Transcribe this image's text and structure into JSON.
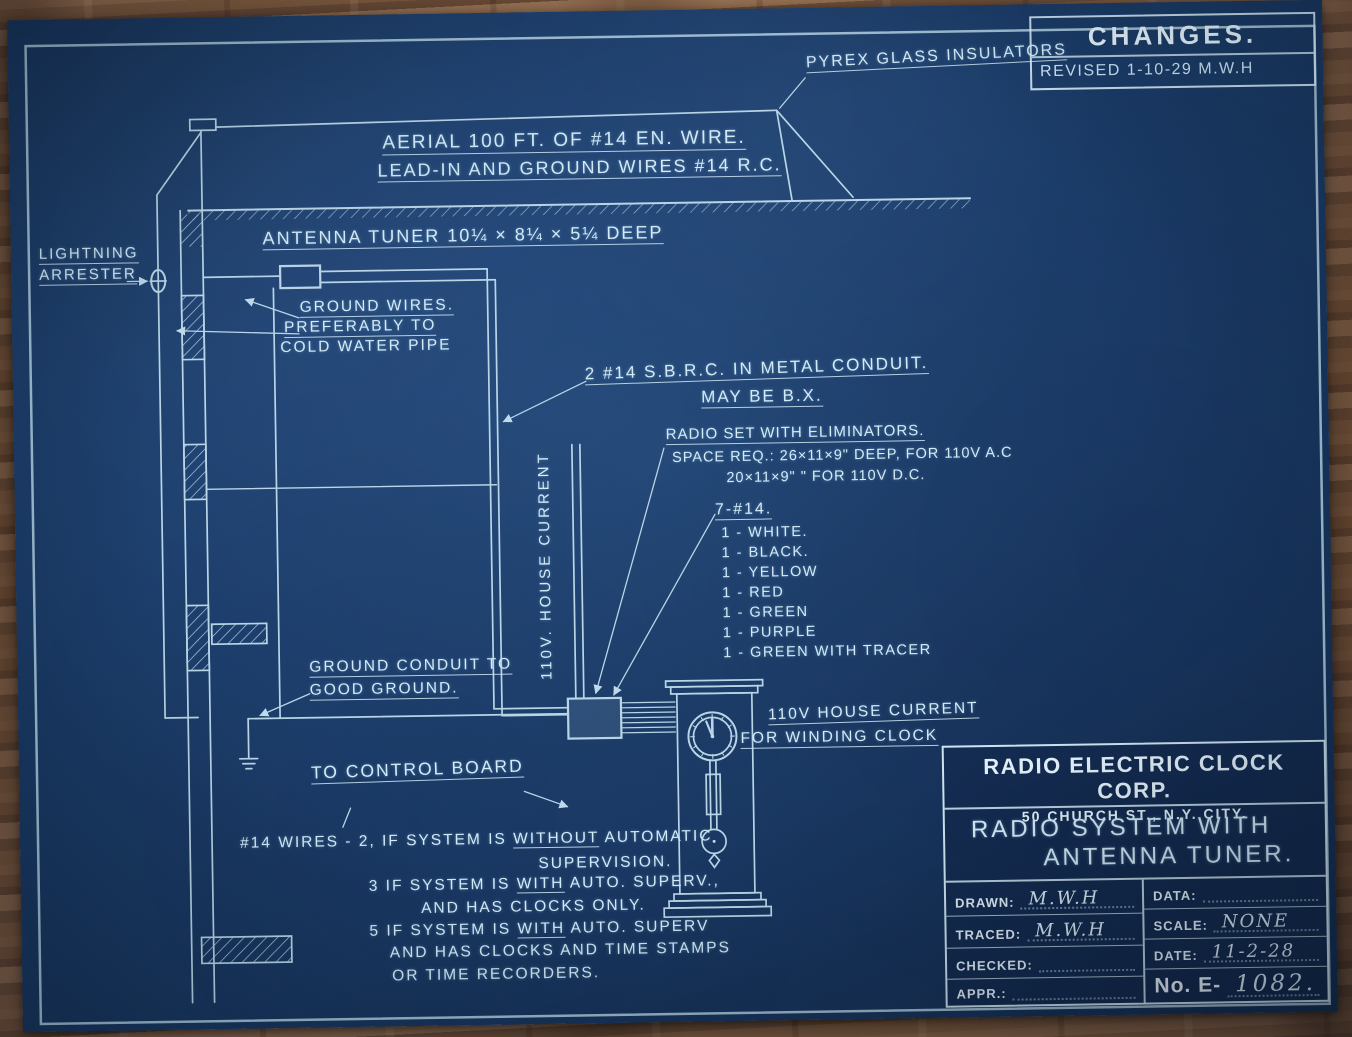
{
  "changes": {
    "title": "CHANGES.",
    "revised": "REVISED 1-10-29 M.W.H"
  },
  "labels": {
    "pyrex": "PYREX GLASS INSULATORS",
    "aerial1": "AERIAL 100 FT. OF #14 EN. WIRE.",
    "aerial2": "LEAD-IN AND GROUND WIRES #14 R.C.",
    "tuner": "ANTENNA TUNER 10¼ × 8¼ × 5¼ DEEP",
    "lightning1": "LIGHTNING",
    "lightning2": "ARRESTER",
    "ground1": "GROUND WIRES.",
    "ground2": "PREFERABLY TO",
    "ground3": "COLD WATER PIPE",
    "conduit1": "2 #14 S.B.R.C. IN METAL CONDUIT.",
    "conduit2": "MAY BE B.X.",
    "radio1": "RADIO SET WITH ELIMINATORS.",
    "radio2": "SPACE REQ.: 26×11×9\" DEEP, FOR 110V A.C",
    "radio3": "20×11×9\"   \"        FOR 110V D.C.",
    "seven_title": "7-#14.",
    "house_current": "110V. HOUSE CURRENT",
    "ground_conduit1": "GROUND CONDUIT TO",
    "ground_conduit2": "GOOD GROUND.",
    "winding1": "110V HOUSE CURRENT",
    "winding2": "FOR WINDING CLOCK",
    "control_board": "TO CONTROL BOARD"
  },
  "wire_list": [
    "1 - WHITE.",
    "1 - BLACK.",
    "1 - YELLOW",
    "1 - RED",
    "1 - GREEN",
    "1 - PURPLE",
    "1 - GREEN WITH TRACER"
  ],
  "notes": {
    "l1a": "#14 WIRES - 2, IF SYSTEM IS ",
    "l1b": "WITHOUT",
    "l1c": " AUTOMATIC",
    "l2": "SUPERVISION.",
    "l3a": "3 IF SYSTEM IS ",
    "l3b": "WITH",
    "l3c": " AUTO. SUPERV.,",
    "l4": "AND HAS CLOCKS ONLY.",
    "l5a": "5 IF SYSTEM IS ",
    "l5b": "WITH",
    "l5c": " AUTO. SUPERV",
    "l6": "AND HAS CLOCKS AND TIME STAMPS",
    "l7": "OR TIME RECORDERS."
  },
  "title_block": {
    "company": "RADIO ELECTRIC CLOCK CORP.",
    "address": "50 CHURCH ST., N.Y. CITY.",
    "title1": "RADIO SYSTEM WITH",
    "title2": "ANTENNA TUNER.",
    "drawn_label": "DRAWN:",
    "drawn_value": "M.W.H",
    "traced_label": "TRACED:",
    "traced_value": "M.W.H",
    "checked_label": "CHECKED:",
    "checked_value": "",
    "appr_label": "APPR.:",
    "appr_value": "",
    "data_label": "DATA:",
    "data_value": "",
    "scale_label": "SCALE:",
    "scale_value": "NONE",
    "date_label": "DATE:",
    "date_value": "11-2-28",
    "number_label": "No. E-",
    "number_value": "1082."
  },
  "colors": {
    "paper_blue": "#1d3f6e",
    "line_blue_white": "#cde7f5",
    "wood_brown": "#8a6242"
  }
}
